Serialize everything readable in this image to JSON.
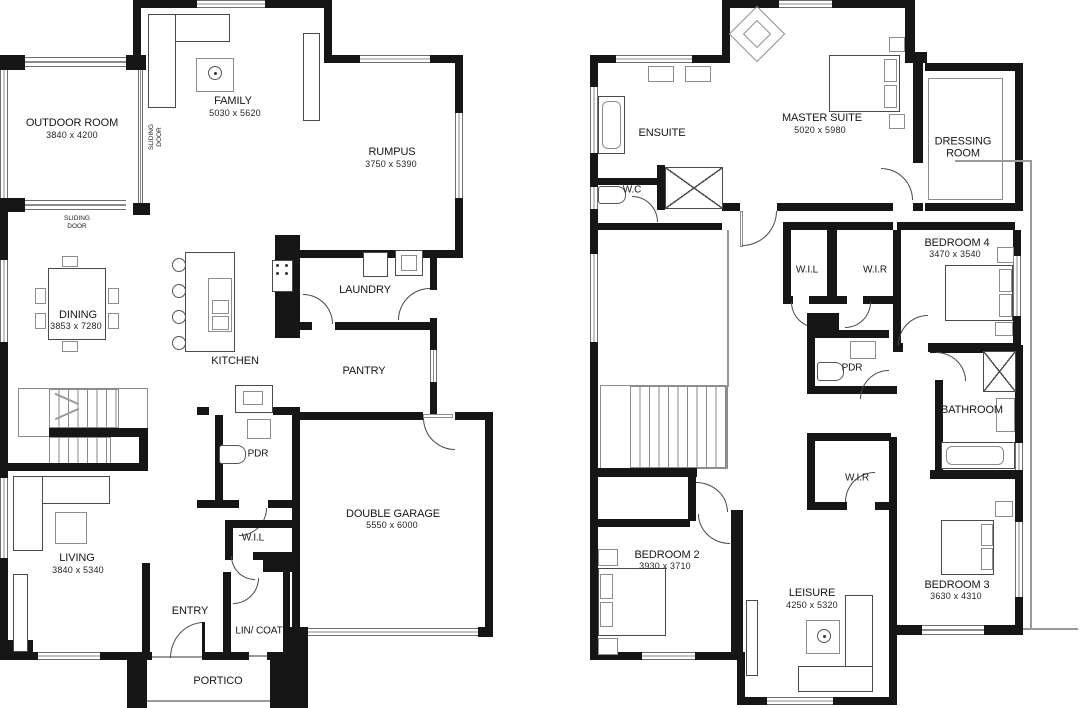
{
  "gf": {
    "rooms": {
      "outdoor": {
        "name": "OUTDOOR ROOM",
        "dims": "3840 x 4200"
      },
      "family": {
        "name": "FAMILY",
        "dims": "5030 x 5620"
      },
      "rumpus": {
        "name": "RUMPUS",
        "dims": "3750 x 5390"
      },
      "dining": {
        "name": "DINING",
        "dims": "3853 x 7280"
      },
      "kitchen": {
        "name": "KITCHEN"
      },
      "laundry": {
        "name": "LAUNDRY"
      },
      "pantry": {
        "name": "PANTRY"
      },
      "pdr": {
        "name": "PDR"
      },
      "living": {
        "name": "LIVING",
        "dims": "3840 x 5340"
      },
      "wil": {
        "name": "W.I.L"
      },
      "garage": {
        "name": "DOUBLE GARAGE",
        "dims": "5550 x 6000"
      },
      "entry": {
        "name": "ENTRY"
      },
      "lincoat": {
        "name": "LIN/ COAT"
      },
      "portico": {
        "name": "PORTICO"
      }
    },
    "notes": {
      "sliding_door_side": "SLIDING DOOR",
      "sliding_door_bottom": "SLIDING DOOR"
    }
  },
  "ff": {
    "rooms": {
      "ensuite": {
        "name": "ENSUITE"
      },
      "wc": {
        "name": "W.C"
      },
      "master": {
        "name": "MASTER SUITE",
        "dims": "5020 x 5980"
      },
      "dressing": {
        "name": "DRESSING ROOM"
      },
      "bed4": {
        "name": "BEDROOM 4",
        "dims": "3470 x 3540"
      },
      "wil": {
        "name": "W.I.L"
      },
      "wir": {
        "name": "W.I.R"
      },
      "pdr": {
        "name": "PDR"
      },
      "bathroom": {
        "name": "BATHROOM"
      },
      "wir2": {
        "name": "W.I.R"
      },
      "bed2": {
        "name": "BEDROOM 2",
        "dims": "3930 x 3710"
      },
      "leisure": {
        "name": "LEISURE",
        "dims": "4250 x 5320"
      },
      "bed3": {
        "name": "BEDROOM 3",
        "dims": "3630 x 4310"
      }
    }
  },
  "colors": {
    "wall": "#161616",
    "line_gray": "#8a8a8a",
    "background": "#ffffff",
    "text": "#161616"
  }
}
